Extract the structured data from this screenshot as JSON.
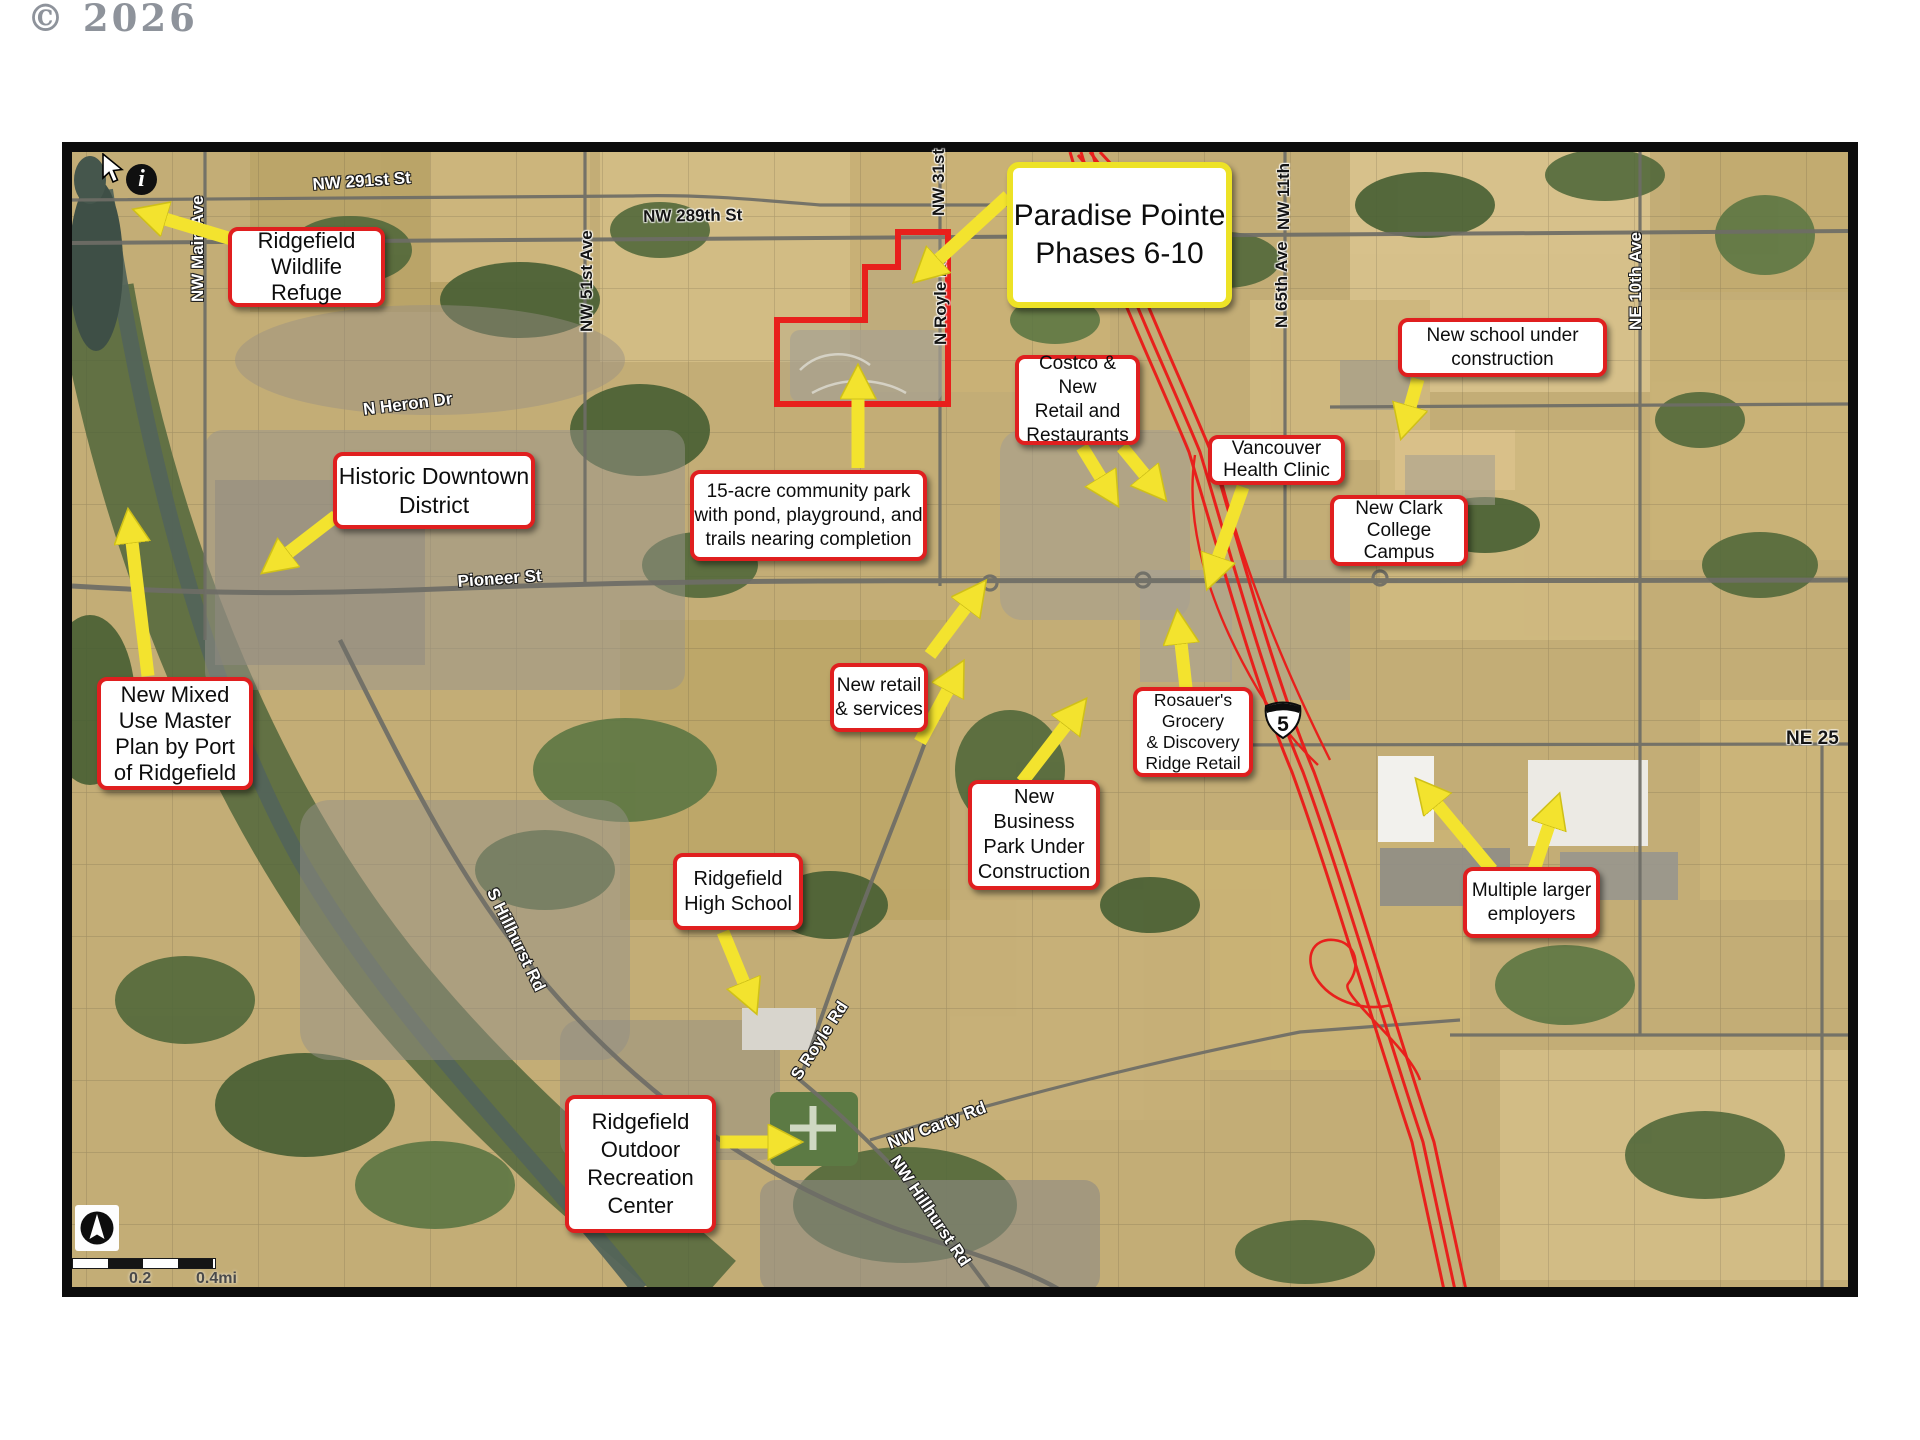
{
  "page": {
    "copyright": "© 2026"
  },
  "map": {
    "info_icon": "i",
    "interstate_shield": "5",
    "scale_labels": [
      "0.2",
      "0.4mi"
    ],
    "colors": {
      "callout_border_red": "#e01f1f",
      "paradise_border_yellow": "#ede226",
      "arrow_yellow": "#f3e32e",
      "highway_red": "#e8201c",
      "parcel_red": "#e8201c"
    },
    "callouts": [
      {
        "id": "wildlife-refuge",
        "text": "Ridgefield\nWildlife\nRefuge"
      },
      {
        "id": "historic-downtown",
        "text": "Historic Downtown\nDistrict"
      },
      {
        "id": "mixed-use",
        "text": "New Mixed\nUse Master\nPlan by Port\nof Ridgefield"
      },
      {
        "id": "paradise-pointe",
        "text": "Paradise Pointe\nPhases 6-10"
      },
      {
        "id": "community-park",
        "text": "15-acre community park\nwith pond, playground, and\ntrails nearing completion"
      },
      {
        "id": "costco-retail",
        "text": "Costco & New\nRetail and\nRestaurants"
      },
      {
        "id": "vancouver-clinic",
        "text": "Vancouver\nHealth Clinic"
      },
      {
        "id": "new-school",
        "text": "New school under\nconstruction"
      },
      {
        "id": "clark-college",
        "text": "New Clark\nCollege\nCampus"
      },
      {
        "id": "new-retail",
        "text": "New retail\n& services"
      },
      {
        "id": "rosauers",
        "text": "Rosauer's\nGrocery\n& Discovery\nRidge Retail"
      },
      {
        "id": "business-park",
        "text": "New Business\nPark Under\nConstruction"
      },
      {
        "id": "high-school",
        "text": "Ridgefield\nHigh School"
      },
      {
        "id": "employers",
        "text": "Multiple larger\nemployers"
      },
      {
        "id": "recreation-center",
        "text": "Ridgefield\nOutdoor\nRecreation\nCenter"
      }
    ],
    "streets": [
      {
        "name": "NW 291st St"
      },
      {
        "name": "NW Main Ave"
      },
      {
        "name": "NW 289th St"
      },
      {
        "name": "NW 51st Ave"
      },
      {
        "name": "NW 31st"
      },
      {
        "name": "N Royle Rd"
      },
      {
        "name": "NW 11th"
      },
      {
        "name": "N 65th Ave"
      },
      {
        "name": "NE 10th Ave"
      },
      {
        "name": "N Heron Dr"
      },
      {
        "name": "Pioneer St"
      },
      {
        "name": "S Hillhurst Rd"
      },
      {
        "name": "S Royle Rd"
      },
      {
        "name": "NW Carty Rd"
      },
      {
        "name": "NW Hillhurst Rd"
      },
      {
        "name": "NE 25"
      }
    ]
  }
}
